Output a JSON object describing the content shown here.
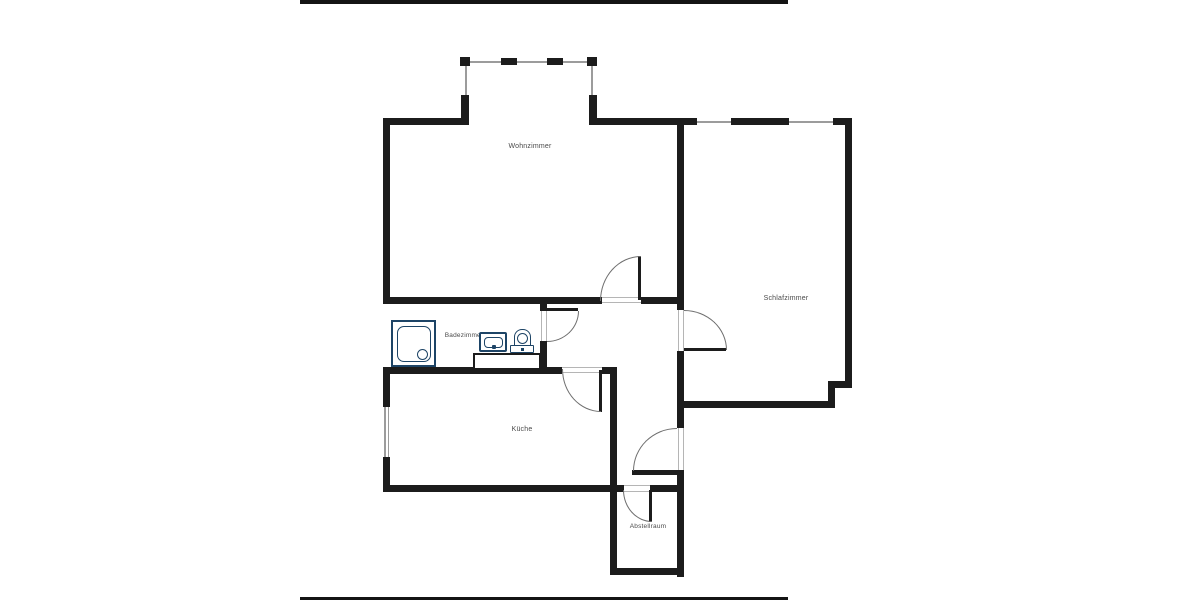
{
  "page": {
    "background": "#ffffff"
  },
  "artifact_bars": {
    "top_visible": true,
    "bottom_visible": true
  },
  "floorplan": {
    "rooms": [
      {
        "id": "wohnzimmer",
        "label": "Wohnzimmer"
      },
      {
        "id": "schlafzimmer",
        "label": "Schlafzimmer"
      },
      {
        "id": "badezimmer",
        "label": "Badezimmer"
      },
      {
        "id": "kueche",
        "label": "Küche"
      },
      {
        "id": "abstellraum",
        "label": "Abstellraum"
      }
    ],
    "fixtures": [
      "shower-icon",
      "sink-icon",
      "toilet-icon",
      "vanity-counter"
    ],
    "doors": [
      "living-room-door",
      "bedroom-door",
      "bathroom-door",
      "kitchen-door",
      "entry-door",
      "storage-door"
    ],
    "windows": [
      "balcony-window-band",
      "bedroom-top-window",
      "kitchen-side-window"
    ],
    "colors": {
      "wall": "#1c1c1c",
      "bar": "#141414",
      "line": "#9c9c9c",
      "threshold": "#b5b5b5",
      "arc": "#6e6e6e",
      "fixture": "#1d4466",
      "label": "#4a4a4a"
    }
  }
}
